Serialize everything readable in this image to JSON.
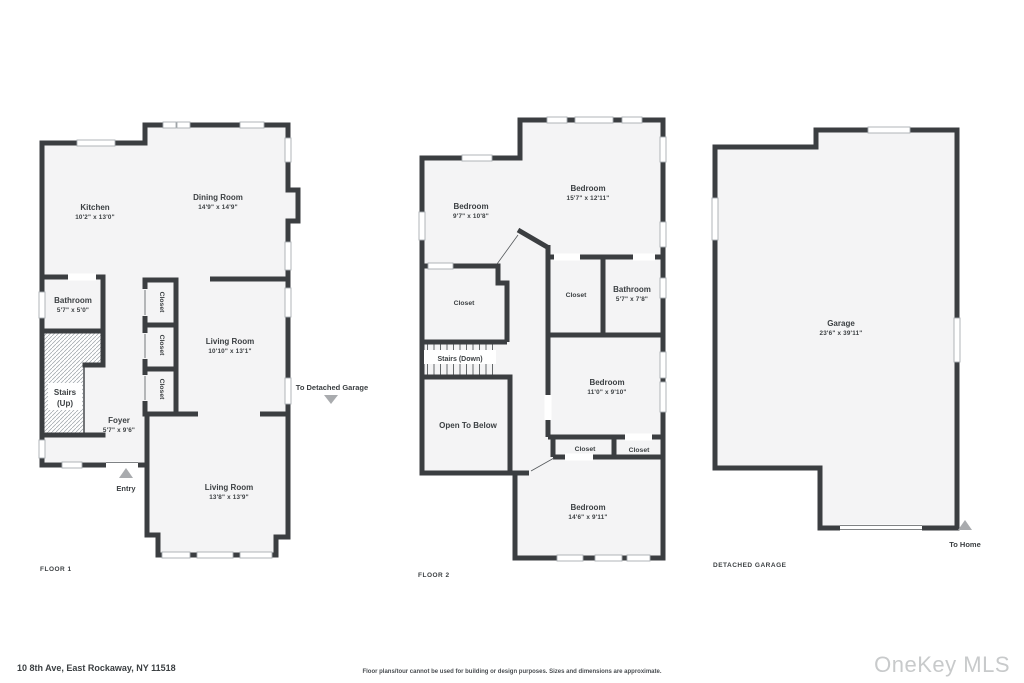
{
  "colors": {
    "wall": "#3b3e41",
    "floor": "#f4f4f5",
    "ink": "#3c4043",
    "thin": "#a9aeb2",
    "marker": "#a9abae",
    "watermark": "#c8cacb"
  },
  "footer": {
    "address": "10 8th Ave, East Rockaway, NY 11518",
    "disclaimer": "Floor plans/tour cannot be used for building or design purposes. Sizes and dimensions are approximate.",
    "watermark": "OneKey MLS"
  },
  "floor1": {
    "caption": "FLOOR 1",
    "kitchen": {
      "name": "Kitchen",
      "dims": "10'2\" x 13'0\""
    },
    "dining_room": {
      "name": "Dining Room",
      "dims": "14'9\" x 14'9\""
    },
    "bathroom": {
      "name": "Bathroom",
      "dims": "5'7\" x 5'0\""
    },
    "stairs_line1": "Stairs",
    "stairs_line2": "(Up)",
    "foyer": {
      "name": "Foyer",
      "dims": "5'7\" x 9'6\""
    },
    "living_room_upper": {
      "name": "Living Room",
      "dims": "10'10\" x 13'1\""
    },
    "living_room_lower": {
      "name": "Living Room",
      "dims": "13'8\" x 13'9\""
    },
    "closets": [
      "Closet",
      "Closet",
      "Closet"
    ],
    "entry_label": "Entry",
    "to_garage_label": "To Detached Garage"
  },
  "floor2": {
    "caption": "FLOOR 2",
    "bedroom_left": {
      "name": "Bedroom",
      "dims": "9'7\" x 10'8\""
    },
    "bedroom_top": {
      "name": "Bedroom",
      "dims": "15'7\" x 12'11\""
    },
    "closet_left": "Closet",
    "closet_middle": "Closet",
    "bathroom": {
      "name": "Bathroom",
      "dims": "5'7\" x 7'8\""
    },
    "stairs_label": "Stairs (Down)",
    "open_to_below": "Open To Below",
    "bedroom_right": {
      "name": "Bedroom",
      "dims": "11'0\" x 9'10\""
    },
    "closet_row": [
      "Closet",
      "Closet"
    ],
    "bedroom_bottom": {
      "name": "Bedroom",
      "dims": "14'6\" x 9'11\""
    }
  },
  "garage": {
    "caption": "DETACHED GARAGE",
    "garage_room": {
      "name": "Garage",
      "dims": "23'6\" x 39'11\""
    },
    "to_home_label": "To Home"
  }
}
